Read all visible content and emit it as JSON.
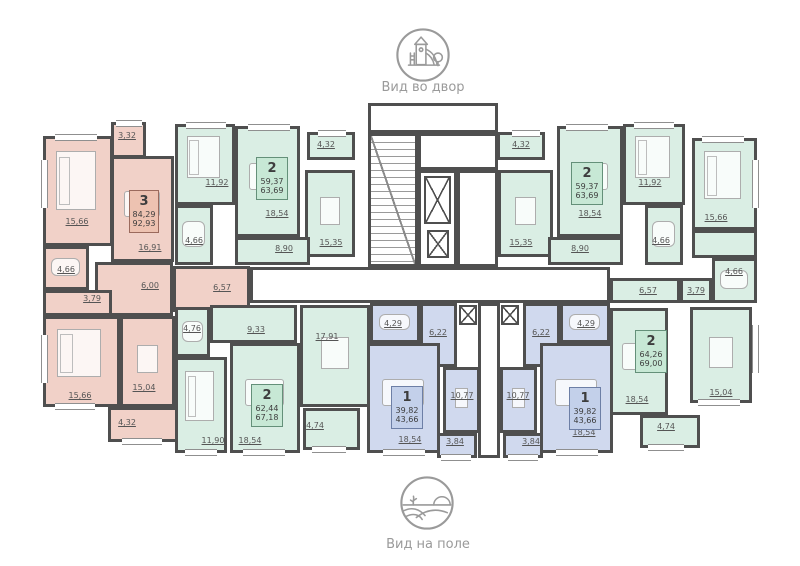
{
  "views": {
    "courtyard": {
      "caption": "Вид во двор",
      "icon": "playground-icon"
    },
    "field": {
      "caption": "Вид на поле",
      "icon": "field-icon"
    }
  },
  "plan": {
    "wall_color": "#4f4f4f",
    "apartment_colors": {
      "red": "#f1d1c8",
      "green": "#daeee4",
      "blue": "#d0d9ee"
    },
    "label_color": "#555555",
    "rooms": [
      {
        "id": "red-hall",
        "c": "red",
        "x": 95,
        "y": 262,
        "w": 78,
        "h": 54,
        "area": "6,00",
        "lx": 150,
        "ly": 286
      },
      {
        "id": "red-bedroom-1",
        "c": "red",
        "x": 43,
        "y": 136,
        "w": 70,
        "h": 110,
        "area": "15,66",
        "lx": 77,
        "ly": 222,
        "f": "bed"
      },
      {
        "id": "red-balcony-1",
        "c": "red",
        "x": 111,
        "y": 122,
        "w": 35,
        "h": 36,
        "area": "3,32",
        "lx": 127,
        "ly": 136
      },
      {
        "id": "red-living",
        "c": "red",
        "x": 111,
        "y": 156,
        "w": 63,
        "h": 106,
        "area": "16,91",
        "lx": 150,
        "ly": 248,
        "f": "sofa"
      },
      {
        "id": "red-bath",
        "c": "red",
        "x": 43,
        "y": 246,
        "w": 46,
        "h": 44,
        "area": "4,66",
        "lx": 66,
        "ly": 270,
        "f": "tub"
      },
      {
        "id": "red-wc",
        "c": "red",
        "x": 43,
        "y": 290,
        "w": 69,
        "h": 26,
        "area": "3,79",
        "lx": 92,
        "ly": 299
      },
      {
        "id": "red-hall-2",
        "c": "red",
        "x": 173,
        "y": 266,
        "w": 77,
        "h": 46,
        "area": "6,57",
        "lx": 222,
        "ly": 288
      },
      {
        "id": "red-bedroom-2",
        "c": "red",
        "x": 43,
        "y": 316,
        "w": 77,
        "h": 91,
        "area": "15,66",
        "lx": 80,
        "ly": 396,
        "f": "bed"
      },
      {
        "id": "red-kitchen",
        "c": "red",
        "x": 120,
        "y": 316,
        "w": 55,
        "h": 91,
        "area": "15,04",
        "lx": 144,
        "ly": 388,
        "f": "table"
      },
      {
        "id": "red-balcony-2",
        "c": "red",
        "x": 108,
        "y": 407,
        "w": 70,
        "h": 35,
        "area": "4,32",
        "lx": 127,
        "ly": 423
      },
      {
        "id": "gtl-bedroom",
        "c": "green",
        "x": 175,
        "y": 124,
        "w": 60,
        "h": 81,
        "area": "11,92",
        "lx": 217,
        "ly": 183,
        "f": "bed"
      },
      {
        "id": "gtl-living",
        "c": "green",
        "x": 235,
        "y": 126,
        "w": 65,
        "h": 111,
        "area": "18,54",
        "lx": 277,
        "ly": 214,
        "f": "sofa"
      },
      {
        "id": "gtl-balcony",
        "c": "green",
        "x": 307,
        "y": 132,
        "w": 48,
        "h": 28,
        "area": "4,32",
        "lx": 326,
        "ly": 145
      },
      {
        "id": "gtl-kitchen",
        "c": "green",
        "x": 305,
        "y": 170,
        "w": 50,
        "h": 87,
        "area": "15,35",
        "lx": 331,
        "ly": 243,
        "f": "table"
      },
      {
        "id": "gtl-bath",
        "c": "green",
        "x": 175,
        "y": 205,
        "w": 38,
        "h": 60,
        "area": "4,66",
        "lx": 194,
        "ly": 241,
        "f": "tub"
      },
      {
        "id": "gtl-hall",
        "c": "green",
        "x": 235,
        "y": 237,
        "w": 75,
        "h": 28,
        "area": "8,90",
        "lx": 284,
        "ly": 249
      },
      {
        "id": "gtr-balcony",
        "c": "green",
        "x": 497,
        "y": 132,
        "w": 48,
        "h": 28,
        "area": "4,32",
        "lx": 521,
        "ly": 145
      },
      {
        "id": "gtr-kitchen",
        "c": "green",
        "x": 498,
        "y": 170,
        "w": 55,
        "h": 87,
        "area": "15,35",
        "lx": 521,
        "ly": 243,
        "f": "table"
      },
      {
        "id": "gtr-living",
        "c": "green",
        "x": 557,
        "y": 126,
        "w": 66,
        "h": 111,
        "area": "18,54",
        "lx": 590,
        "ly": 214,
        "f": "sofa"
      },
      {
        "id": "gtr-bedroom",
        "c": "green",
        "x": 623,
        "y": 124,
        "w": 62,
        "h": 81,
        "area": "11,92",
        "lx": 650,
        "ly": 183,
        "f": "bed"
      },
      {
        "id": "gtr-bath",
        "c": "green",
        "x": 645,
        "y": 205,
        "w": 38,
        "h": 60,
        "area": "4,66",
        "lx": 661,
        "ly": 241,
        "f": "tub"
      },
      {
        "id": "gtr-hall",
        "c": "green",
        "x": 548,
        "y": 237,
        "w": 75,
        "h": 28,
        "area": "8,90",
        "lx": 580,
        "ly": 249
      },
      {
        "id": "gbr-bedroom",
        "c": "green",
        "x": 692,
        "y": 138,
        "w": 65,
        "h": 92,
        "area": "15,66",
        "lx": 716,
        "ly": 218,
        "f": "bed"
      },
      {
        "id": "gbr-wardrobe",
        "c": "green",
        "x": 692,
        "y": 230,
        "w": 65,
        "h": 28
      },
      {
        "id": "gbr-hall",
        "c": "green",
        "x": 610,
        "y": 278,
        "w": 70,
        "h": 25,
        "area": "6,57",
        "lx": 648,
        "ly": 291
      },
      {
        "id": "gbr-wc",
        "c": "green",
        "x": 680,
        "y": 278,
        "w": 32,
        "h": 25,
        "area": "3,79",
        "lx": 696,
        "ly": 291
      },
      {
        "id": "gbr-bath",
        "c": "green",
        "x": 712,
        "y": 258,
        "w": 45,
        "h": 45,
        "area": "4,66",
        "lx": 734,
        "ly": 272,
        "f": "tub"
      },
      {
        "id": "gbr-living",
        "c": "green",
        "x": 610,
        "y": 308,
        "w": 58,
        "h": 107,
        "area": "18,54",
        "lx": 637,
        "ly": 400,
        "f": "sofa"
      },
      {
        "id": "gbr-kitchen",
        "c": "green",
        "x": 690,
        "y": 307,
        "w": 62,
        "h": 96,
        "area": "15,04",
        "lx": 721,
        "ly": 393,
        "f": "table"
      },
      {
        "id": "gbr-balcony",
        "c": "green",
        "x": 640,
        "y": 415,
        "w": 60,
        "h": 33,
        "area": "4,74",
        "lx": 666,
        "ly": 427
      },
      {
        "id": "gbl-bath",
        "c": "green",
        "x": 175,
        "y": 307,
        "w": 35,
        "h": 50,
        "area": "4,76",
        "lx": 192,
        "ly": 329,
        "f": "tub"
      },
      {
        "id": "gbl-hall",
        "c": "green",
        "x": 210,
        "y": 305,
        "w": 87,
        "h": 38,
        "area": "9,33",
        "lx": 256,
        "ly": 330
      },
      {
        "id": "gbl-kitchen-living",
        "c": "green",
        "x": 300,
        "y": 305,
        "w": 70,
        "h": 102,
        "area": "17,91",
        "lx": 327,
        "ly": 337,
        "f": "table"
      },
      {
        "id": "gbl-bedroom",
        "c": "green",
        "x": 175,
        "y": 357,
        "w": 52,
        "h": 96,
        "area": "11,90",
        "lx": 213,
        "ly": 441,
        "f": "bed"
      },
      {
        "id": "gbl-living",
        "c": "green",
        "x": 230,
        "y": 343,
        "w": 70,
        "h": 110,
        "area": "18,54",
        "lx": 250,
        "ly": 441,
        "f": "sofa"
      },
      {
        "id": "gbl-balcony",
        "c": "green",
        "x": 303,
        "y": 408,
        "w": 57,
        "h": 42,
        "area": "4,74",
        "lx": 315,
        "ly": 426
      },
      {
        "id": "bl-bath",
        "c": "blue",
        "x": 370,
        "y": 303,
        "w": 50,
        "h": 40,
        "area": "4,29",
        "lx": 393,
        "ly": 324,
        "f": "tub"
      },
      {
        "id": "bl-hall",
        "c": "blue",
        "x": 420,
        "y": 303,
        "w": 37,
        "h": 64,
        "area": "6,22",
        "lx": 438,
        "ly": 333
      },
      {
        "id": "bl-living",
        "c": "blue",
        "x": 367,
        "y": 343,
        "w": 73,
        "h": 110,
        "area": "18,54",
        "lx": 410,
        "ly": 440,
        "f": "sofa"
      },
      {
        "id": "bl-kitchen",
        "c": "blue",
        "x": 443,
        "y": 367,
        "w": 37,
        "h": 66,
        "area": "10,77",
        "lx": 462,
        "ly": 396,
        "f": "table"
      },
      {
        "id": "bl-balcony",
        "c": "blue",
        "x": 437,
        "y": 433,
        "w": 40,
        "h": 25,
        "area": "3,84",
        "lx": 455,
        "ly": 442
      },
      {
        "id": "br-hall",
        "c": "blue",
        "x": 523,
        "y": 303,
        "w": 37,
        "h": 64,
        "area": "6,22",
        "lx": 541,
        "ly": 333
      },
      {
        "id": "br-bath",
        "c": "blue",
        "x": 560,
        "y": 303,
        "w": 50,
        "h": 40,
        "area": "4,29",
        "lx": 586,
        "ly": 324,
        "f": "tub"
      },
      {
        "id": "br-kitchen",
        "c": "blue",
        "x": 500,
        "y": 367,
        "w": 37,
        "h": 66,
        "area": "10,77",
        "lx": 518,
        "ly": 396,
        "f": "table"
      },
      {
        "id": "br-living",
        "c": "blue",
        "x": 540,
        "y": 343,
        "w": 73,
        "h": 110,
        "area": "18,54",
        "lx": 584,
        "ly": 433,
        "f": "sofa"
      },
      {
        "id": "br-balcony",
        "c": "blue",
        "x": 503,
        "y": 433,
        "w": 40,
        "h": 25,
        "area": "3,84",
        "lx": 531,
        "ly": 442
      },
      {
        "id": "lobby",
        "c": "white",
        "x": 368,
        "y": 103,
        "w": 130,
        "h": 30
      },
      {
        "id": "stairs",
        "c": "white",
        "x": 368,
        "y": 133,
        "w": 50,
        "h": 134
      },
      {
        "id": "elevator-hall",
        "c": "white",
        "x": 418,
        "y": 133,
        "w": 80,
        "h": 37
      },
      {
        "id": "elevator-shaft",
        "c": "white",
        "x": 418,
        "y": 170,
        "w": 39,
        "h": 97
      },
      {
        "id": "vestibule",
        "c": "white",
        "x": 457,
        "y": 170,
        "w": 41,
        "h": 97
      },
      {
        "id": "corridor",
        "c": "white",
        "x": 250,
        "y": 267,
        "w": 360,
        "h": 36
      },
      {
        "id": "duct",
        "c": "white",
        "x": 478,
        "y": 303,
        "w": 22,
        "h": 155
      }
    ],
    "apartment_badges": [
      {
        "rooms": "3",
        "area_living": "84,29",
        "area_total": "92,93",
        "color": "red",
        "x": 129,
        "y": 190,
        "w": 30,
        "h": 43
      },
      {
        "rooms": "2",
        "area_living": "59,37",
        "area_total": "63,69",
        "color": "green",
        "x": 256,
        "y": 157,
        "w": 32,
        "h": 43
      },
      {
        "rooms": "2",
        "area_living": "59,37",
        "area_total": "63,69",
        "color": "green",
        "x": 571,
        "y": 162,
        "w": 32,
        "h": 43
      },
      {
        "rooms": "2",
        "area_living": "62,44",
        "area_total": "67,18",
        "color": "green",
        "x": 251,
        "y": 384,
        "w": 32,
        "h": 43
      },
      {
        "rooms": "2",
        "area_living": "64,26",
        "area_total": "69,00",
        "color": "green",
        "x": 635,
        "y": 330,
        "w": 32,
        "h": 43
      },
      {
        "rooms": "1",
        "area_living": "39,82",
        "area_total": "43,66",
        "color": "blue",
        "x": 391,
        "y": 386,
        "w": 32,
        "h": 43
      },
      {
        "rooms": "1",
        "area_living": "39,82",
        "area_total": "43,66",
        "color": "blue",
        "x": 569,
        "y": 387,
        "w": 32,
        "h": 43
      }
    ],
    "elevators": [
      {
        "x": 424,
        "y": 176,
        "w": 27,
        "h": 48
      },
      {
        "x": 427,
        "y": 230,
        "w": 22,
        "h": 28
      }
    ],
    "shaft_boxes": [
      {
        "x": 459,
        "y": 305,
        "w": 18,
        "h": 20
      },
      {
        "x": 501,
        "y": 305,
        "w": 18,
        "h": 20
      }
    ],
    "windows": [
      {
        "o": "h",
        "x": 55,
        "y": 134,
        "w": 42
      },
      {
        "o": "h",
        "x": 116,
        "y": 120,
        "w": 26
      },
      {
        "o": "h",
        "x": 186,
        "y": 122,
        "w": 40
      },
      {
        "o": "h",
        "x": 248,
        "y": 124,
        "w": 42
      },
      {
        "o": "h",
        "x": 318,
        "y": 130,
        "w": 28
      },
      {
        "o": "h",
        "x": 512,
        "y": 130,
        "w": 28
      },
      {
        "o": "h",
        "x": 566,
        "y": 124,
        "w": 42
      },
      {
        "o": "h",
        "x": 634,
        "y": 122,
        "w": 40
      },
      {
        "o": "h",
        "x": 702,
        "y": 136,
        "w": 42
      },
      {
        "o": "h",
        "x": 55,
        "y": 403,
        "w": 40
      },
      {
        "o": "h",
        "x": 122,
        "y": 438,
        "w": 40
      },
      {
        "o": "h",
        "x": 185,
        "y": 449,
        "w": 32
      },
      {
        "o": "h",
        "x": 243,
        "y": 449,
        "w": 42
      },
      {
        "o": "h",
        "x": 312,
        "y": 446,
        "w": 34
      },
      {
        "o": "h",
        "x": 383,
        "y": 449,
        "w": 42
      },
      {
        "o": "h",
        "x": 441,
        "y": 454,
        "w": 30
      },
      {
        "o": "h",
        "x": 508,
        "y": 454,
        "w": 30
      },
      {
        "o": "h",
        "x": 556,
        "y": 449,
        "w": 42
      },
      {
        "o": "h",
        "x": 648,
        "y": 444,
        "w": 36
      },
      {
        "o": "h",
        "x": 698,
        "y": 399,
        "w": 42
      },
      {
        "o": "v",
        "x": 41,
        "y": 160,
        "h": 48
      },
      {
        "o": "v",
        "x": 41,
        "y": 335,
        "h": 48
      },
      {
        "o": "v",
        "x": 752,
        "y": 160,
        "h": 48
      },
      {
        "o": "v",
        "x": 752,
        "y": 325,
        "h": 48
      }
    ]
  }
}
